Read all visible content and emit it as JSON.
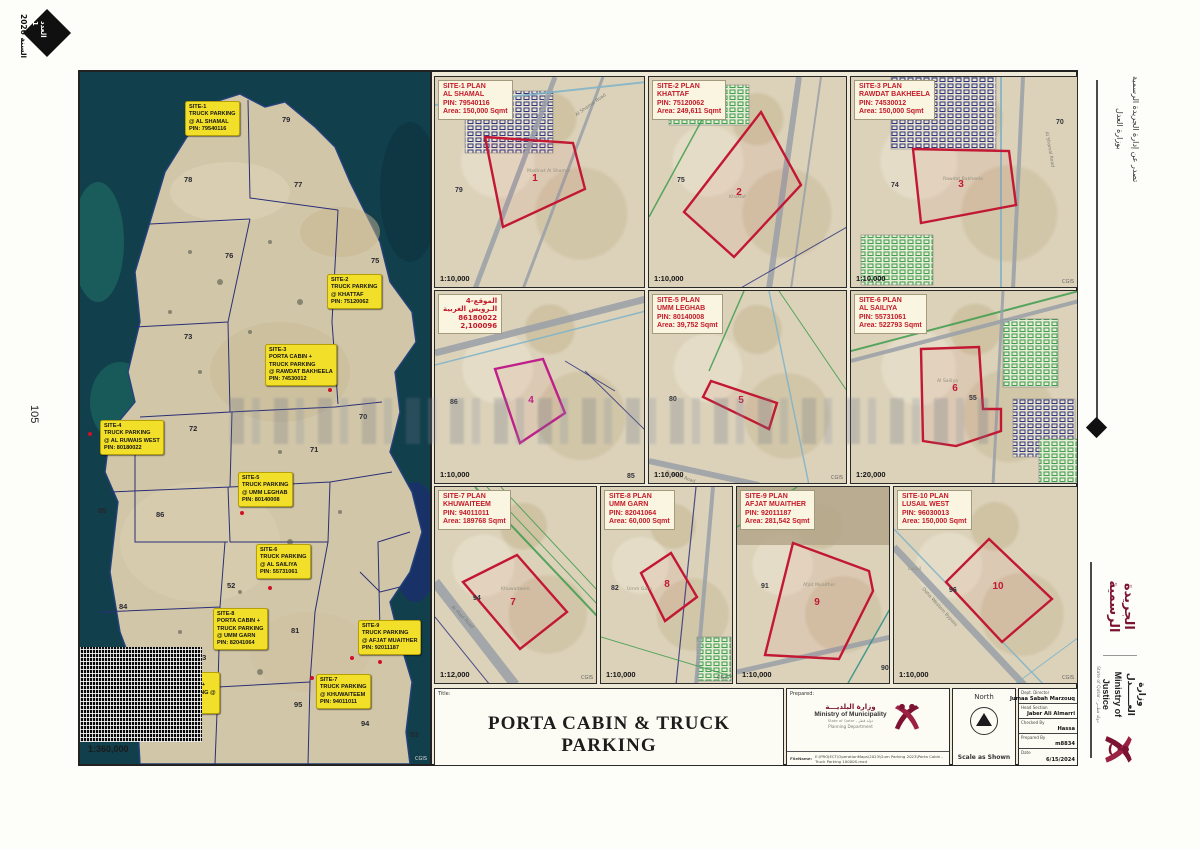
{
  "page": {
    "issue_label": "العدد",
    "issue_number": "1",
    "year_text": "السنة 2026",
    "page_number": "105",
    "issued_line1": "تصدر عن إدارة الجريدة الرسمية",
    "issued_line2": "بوزارة العدل",
    "gazette_name": "الجريدة الرسمية",
    "moj_ar": "وزارة العــــــدل",
    "moj_en": "Ministry of Justice",
    "moj_state": "State of Qatar - دولة قطــر",
    "accent_maroon": "#7d1333",
    "callout_yellow": "#f2df2a",
    "plan_red": "#c21833"
  },
  "map": {
    "scale": "1:360,000",
    "credit": "CGIS",
    "zones": [
      {
        "n": "79",
        "x": 202,
        "y": 43
      },
      {
        "n": "78",
        "x": 104,
        "y": 103
      },
      {
        "n": "77",
        "x": 214,
        "y": 108
      },
      {
        "n": "76",
        "x": 145,
        "y": 179
      },
      {
        "n": "75",
        "x": 291,
        "y": 184
      },
      {
        "n": "73",
        "x": 104,
        "y": 260
      },
      {
        "n": "72",
        "x": 109,
        "y": 352
      },
      {
        "n": "71",
        "x": 230,
        "y": 373
      },
      {
        "n": "70",
        "x": 279,
        "y": 340
      },
      {
        "n": "85",
        "x": 18,
        "y": 434
      },
      {
        "n": "86",
        "x": 76,
        "y": 438
      },
      {
        "n": "52",
        "x": 147,
        "y": 509
      },
      {
        "n": "84",
        "x": 39,
        "y": 530
      },
      {
        "n": "83",
        "x": 118,
        "y": 581
      },
      {
        "n": "81",
        "x": 211,
        "y": 554
      },
      {
        "n": "95",
        "x": 214,
        "y": 628
      },
      {
        "n": "94",
        "x": 281,
        "y": 647
      },
      {
        "n": "96",
        "x": 65,
        "y": 656
      },
      {
        "n": "53",
        "x": 330,
        "y": 658
      }
    ],
    "callouts": [
      {
        "x": 105,
        "y": 29,
        "lines": [
          "SITE-1",
          "TRUCK PARKING",
          "@ AL SHAMAL",
          "PIN: 79540116"
        ]
      },
      {
        "x": 247,
        "y": 202,
        "lines": [
          "SITE-2",
          "TRUCK PARKING",
          "@ KHATTAF",
          "PIN: 75120062"
        ]
      },
      {
        "x": 185,
        "y": 272,
        "lines": [
          "SITE-3",
          "PORTA CABIN +",
          "TRUCK PARKING",
          "@ RAWDAT BAKHEELA",
          "PIN: 74530012"
        ]
      },
      {
        "x": 20,
        "y": 348,
        "lines": [
          "SITE-4",
          "TRUCK PARKING",
          "@ AL RUWAIS WEST",
          "PIN: 80180022"
        ]
      },
      {
        "x": 158,
        "y": 400,
        "lines": [
          "SITE-5",
          "TRUCK PARKING",
          "@ UMM LEGHAB",
          "PIN: 80140008"
        ]
      },
      {
        "x": 176,
        "y": 472,
        "lines": [
          "SITE-6",
          "TRUCK PARKING",
          "@ AL SAILIYA",
          "PIN: 55731061"
        ]
      },
      {
        "x": 133,
        "y": 536,
        "lines": [
          "SITE-8",
          "PORTA CABIN +",
          "TRUCK PARKING",
          "@ UMM GARN",
          "PIN: 82041064"
        ]
      },
      {
        "x": 278,
        "y": 548,
        "lines": [
          "SITE-9",
          "TRUCK PARKING",
          "@ AFJAT MUAITHER",
          "PIN: 92011187"
        ]
      },
      {
        "x": 78,
        "y": 600,
        "lines": [
          "SITE-10",
          "PORTA CABIN +",
          "TRUCK PARKING @",
          "LUSAIL WEST",
          "PIN: 96030013"
        ]
      },
      {
        "x": 236,
        "y": 602,
        "lines": [
          "SITE-7",
          "TRUCK PARKING",
          "@ KHUWAITEEM",
          "PIN: 94011011"
        ]
      }
    ]
  },
  "plans": [
    {
      "line1": "SITE-1 PLAN",
      "line2": "AL SHAMAL",
      "pin": "PIN: 79540116",
      "area": "Area: 150,000 Sqmt",
      "scale": "1:10,000",
      "number": "1",
      "place": "Madinat Al Shamal",
      "road": "Al Shamal Road",
      "zones": [
        "79"
      ],
      "credit": ""
    },
    {
      "line1": "SITE-2 PLAN",
      "line2": "KHATTAF",
      "pin": "PIN: 75120062",
      "area": "Area: 249,611 Sqmt",
      "scale": "1:10,000",
      "number": "2",
      "place": "Khattaf",
      "road": "",
      "zones": [
        "75"
      ],
      "credit": ""
    },
    {
      "line1": "SITE-3 PLAN",
      "line2": "RAWDAT BAKHEELA",
      "pin": "PIN: 74530012",
      "area": "Area: 150,000 Sqmt",
      "scale": "1:10,000",
      "number": "3",
      "place": "Rawdat Bakheela",
      "road": "Al Shamal Road",
      "zones": [
        "74",
        "70"
      ],
      "credit": "CGIS"
    },
    {
      "line1": "الموقع-4",
      "line2": "الـرويس الغربية",
      "pin": "86180022",
      "area": "2,100096",
      "scale": "1:10,000",
      "number": "4",
      "place": "",
      "road": "Dukhan Road",
      "zones": [
        "86",
        "85"
      ],
      "credit": "",
      "rtl": true
    },
    {
      "line1": "SITE-5 PLAN",
      "line2": "UMM LEGHAB",
      "pin": "PIN: 80140008",
      "area": "Area: 39,752 Sqmt",
      "scale": "1:10,000",
      "number": "5",
      "place": "",
      "road": "Dukhan Road",
      "zones": [
        "80"
      ],
      "credit": "CGIS"
    },
    {
      "line1": "SITE-6 PLAN",
      "line2": "AL SAILIYA",
      "pin": "PIN: 55731061",
      "area": "Area: 522793 Sqmt",
      "scale": "1:20,000",
      "number": "6",
      "place": "Al Sailiya",
      "road": "",
      "zones": [
        "55"
      ],
      "credit": ""
    },
    {
      "line1": "SITE-7 PLAN",
      "line2": "KHUWAITEEM",
      "pin": "PIN: 94011011",
      "area": "Area: 189768 Sqmt",
      "scale": "1:12,000",
      "number": "7",
      "place": "Khuwaiteem",
      "road": "Al Majd Road",
      "zones": [
        "94"
      ],
      "credit": "CGIS"
    },
    {
      "line1": "SITE-8 PLAN",
      "line2": "UMM GARN",
      "pin": "PIN: 82041064",
      "area": "Area: 60,000 Sqmt",
      "scale": "1:10,000",
      "number": "8",
      "place": "Umm Garn",
      "road": "",
      "zones": [
        "82"
      ],
      "credit": "CGIS"
    },
    {
      "line1": "SITE-9 PLAN",
      "line2": "AFJAT MUAITHER",
      "pin": "PIN: 92011187",
      "area": "Area: 281,542 Sqmt",
      "scale": "1:10,000",
      "number": "9",
      "place": "Afjat Muaither",
      "road": "",
      "zones": [
        "91",
        "90"
      ],
      "credit": ""
    },
    {
      "line1": "SITE-10 PLAN",
      "line2": "LUSAIL WEST",
      "pin": "PIN: 96030013",
      "area": "Area: 150,000 Sqmt",
      "scale": "1:10,000",
      "number": "10",
      "place": "Lusail",
      "road": "Doha Western Bypass",
      "zones": [
        "96"
      ],
      "credit": "CGIS"
    }
  ],
  "titleblock": {
    "title_label": "Title:",
    "title": "PORTA CABIN & TRUCK PARKING",
    "prepared_label": "Prepared:",
    "mom_ar": "وزارة البلديـــة",
    "mom_en": "Ministry of Municipality",
    "mom_state": "State of Qatar - دولة قطر",
    "mom_dept": "Planning Department",
    "filename_label": "FileName:",
    "filename": "E:\\PROJECT\\OperationMaps\\2023\\Gum Parking 2023\\Porta Cabin - Truck Parking 10000S.mxd",
    "north_label": "North",
    "scale_note": "Scale as Shown",
    "rows": [
      {
        "label": "Dept. Director",
        "value": "Jumaa Sabah Marzouq"
      },
      {
        "label": "Head Section",
        "value": "Jaber Ali Almarri"
      },
      {
        "label": "Checked By",
        "value": "Hassa"
      },
      {
        "label": "Prepared By",
        "value": "m8834"
      },
      {
        "label": "Date",
        "value": "6/15/2024"
      }
    ]
  }
}
